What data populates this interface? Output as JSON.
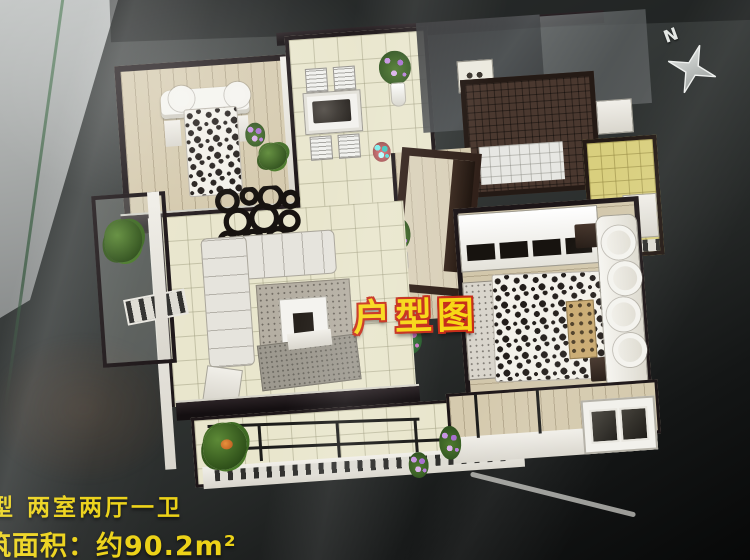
{
  "badge": {
    "text": "户型图",
    "text_color": "#f7d816",
    "outline_color": "#c62d1a"
  },
  "caption": {
    "line1": "型 两室两厅一卫",
    "line2": "筑面积：约90.2m²",
    "color": "#ecd218"
  },
  "compass": {
    "label": "N",
    "icon": "compass-star-icon"
  },
  "palette": {
    "board_dark": "#343837",
    "board_black": "#070808",
    "side_wall_light": "#b3b6b5",
    "floor_beige": "#e9e6cd",
    "floor_wood": "#d5caae",
    "kitchen_tile_yellow": "#d9cf7e",
    "bath_mosaic_brown": "#4a382f",
    "model_wall_black": "#1d1618",
    "model_wall_white": "#ece9e2",
    "bed_spot_fabric": "#f3f1ea"
  }
}
